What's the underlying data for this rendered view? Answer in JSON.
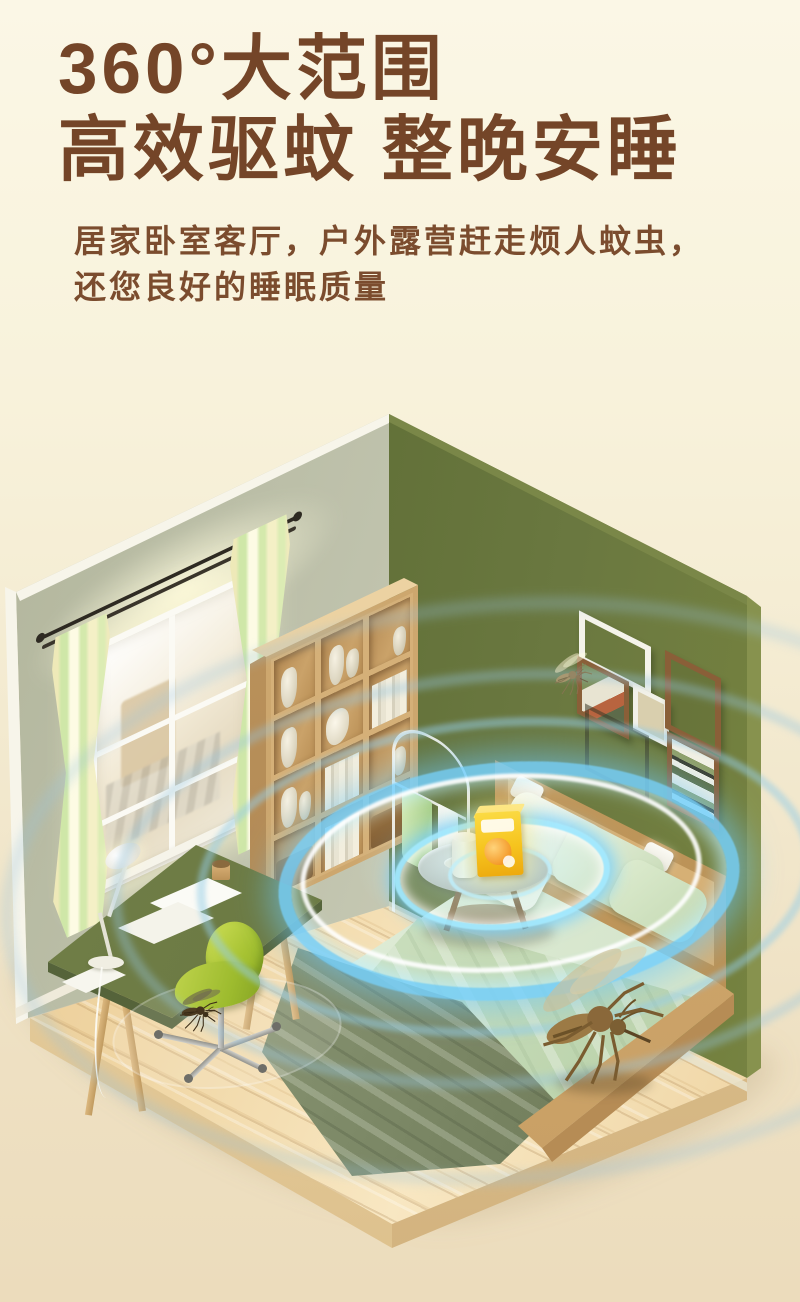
{
  "header": {
    "title_line1": "360°大范围",
    "title_line2": "高效驱蚊 整晚安睡",
    "subtitle_line1": "居家卧室客厅，户外露营赶走烦人蚊虫，",
    "subtitle_line2": "还您良好的睡眠质量"
  },
  "colors": {
    "bg_top": "#fbf7e6",
    "bg_bottom": "#ecdcbc",
    "title": "#744528",
    "subtitle": "#7b4c2e",
    "left_wall": "#c2c5af",
    "right_wall": "#66743c",
    "wall_edge": "#f7f5ea",
    "floor_wood": "#edd09d",
    "furniture_wood": "#d7b279",
    "desk_top": "#6d7b45",
    "chair_green": "#b5cc3e",
    "curtain": "#efecc0",
    "bedding": "#e9f2e0",
    "blanket_throw": "#87936f",
    "wave_blue": "#7fd2fa",
    "product_yellow": "#f6c41e",
    "mosquito_brown": "#8a6a3a"
  },
  "scene": {
    "name": "isometric-bedroom-with-repeller-wave-rings",
    "objects": [
      "window",
      "curtains",
      "bookshelf",
      "clothes-rack",
      "desk",
      "desk-lamp",
      "office-chair",
      "round-side-table",
      "repellent-product-box",
      "bed",
      "pillows",
      "blanket",
      "wall-picture-frames",
      "ultrasonic-wave-rings",
      "mosquitoes"
    ]
  }
}
